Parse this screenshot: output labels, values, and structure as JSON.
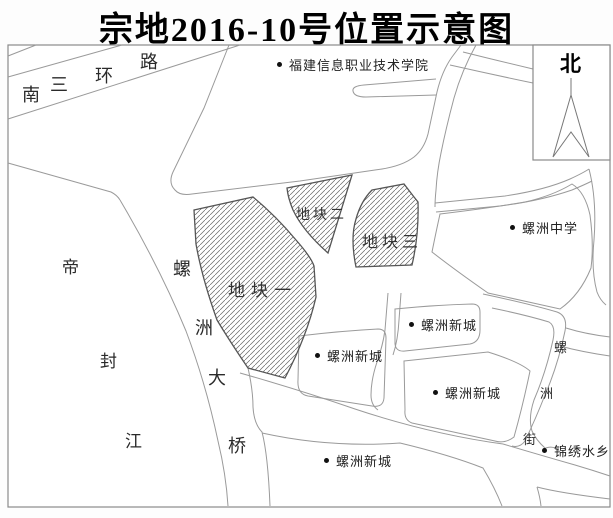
{
  "title": "宗地2016-10号位置示意图",
  "compass": {
    "label": "北"
  },
  "roads": {
    "ring": {
      "name": "南三环路",
      "chars": [
        "南",
        "三",
        "环",
        "路"
      ]
    },
    "bridge": {
      "name": "螺洲大桥",
      "chars": [
        "螺",
        "洲",
        "大",
        "桥"
      ]
    },
    "street": {
      "name": "螺洲街",
      "chars": [
        "螺",
        "洲",
        "街"
      ]
    }
  },
  "river": {
    "name": "帝封江",
    "chars": [
      "帝",
      "封",
      "江"
    ]
  },
  "plots": {
    "p1": {
      "label": "地块一"
    },
    "p2": {
      "label": "地块二"
    },
    "p3": {
      "label": "地块三"
    }
  },
  "pois": {
    "college": {
      "label": "福建信息职业技术学院"
    },
    "school": {
      "label": "螺洲中学"
    },
    "xincheng1": {
      "label": "螺洲新城"
    },
    "xincheng2": {
      "label": "螺洲新城"
    },
    "xincheng3": {
      "label": "螺洲新城"
    },
    "xincheng4": {
      "label": "螺洲新城"
    },
    "jinxiu": {
      "label": "锦绣水乡"
    }
  },
  "colors": {
    "road_line": "#9a9a9a",
    "plot_outline": "#555555",
    "hatch": "#666666",
    "frame": "#8a8a8a",
    "text": "#222222"
  }
}
